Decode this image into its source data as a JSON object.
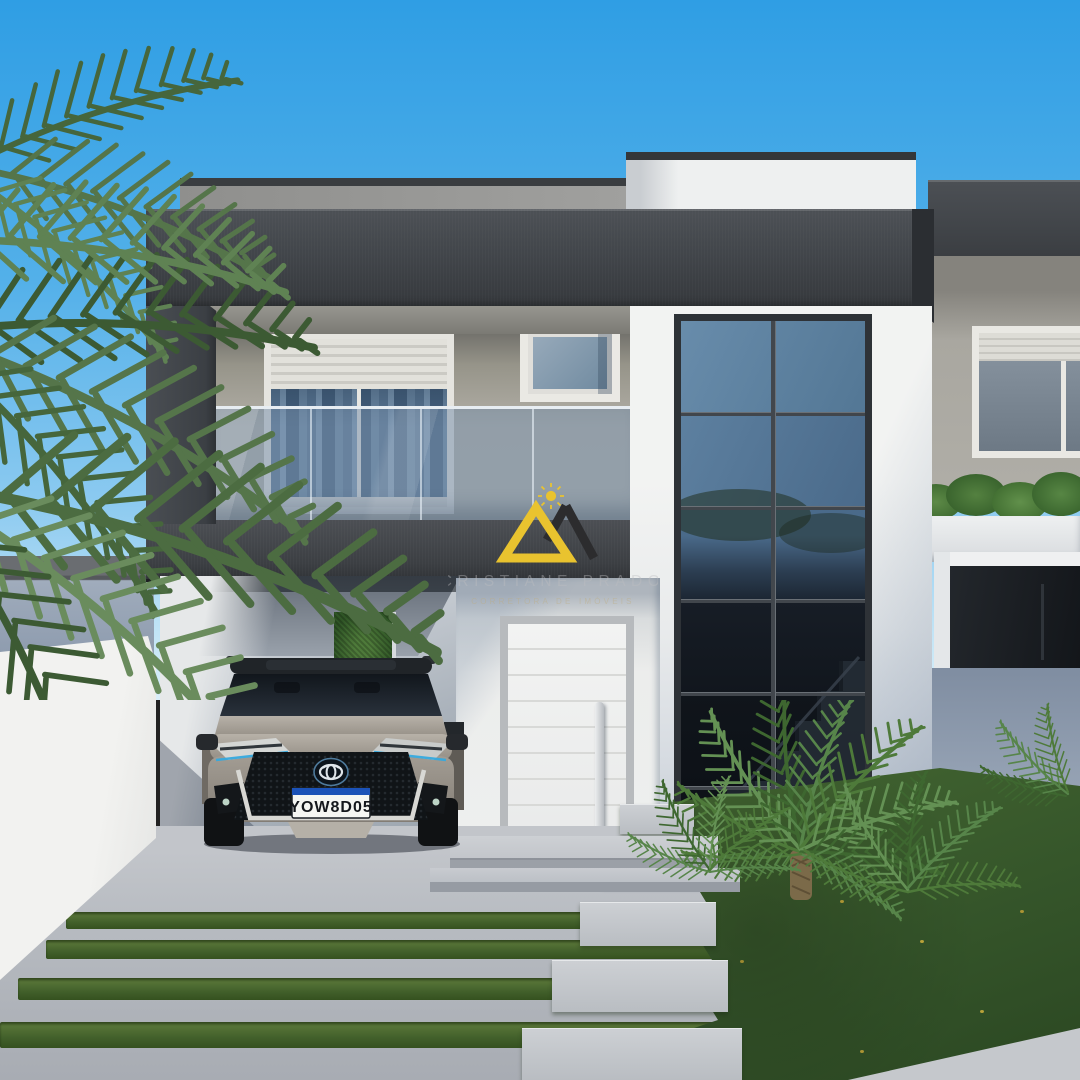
{
  "image": {
    "type": "architectural-render",
    "subject": "Modern two-story duplex house with glass balcony, carport with SUV, double-height window and landscaped yard",
    "style": "photorealistic 3D visualization"
  },
  "watermark": {
    "brand": "CRISTIANE PRADO",
    "tagline": "CORRETORA DE IMÓVEIS",
    "logo": {
      "sun_icon_color": "#e9c32f",
      "triangle_yellow": "#e9c32f",
      "triangle_dark": "#2c2c2e"
    }
  },
  "vehicle": {
    "type": "suv",
    "brand_badge": "toyota-logo",
    "body_color": "silver-gray",
    "license_plate": {
      "text": "YOW8D05",
      "style": "mercosul",
      "stripe_color": "#1b52b8"
    }
  },
  "palette": {
    "sky_top": "#2f9ee4",
    "sky_horizon": "#cfeaf8",
    "fascia_charcoal": "#3f4347",
    "wall_taupe": "#b2afa7",
    "wall_white": "#eceeee",
    "glass_reflection": "#5a7796",
    "balcony_glass": "#748ea8",
    "lawn_green": "#3a5c2d",
    "driveway_concrete": "#b7bbc1",
    "door_white": "#f4f5f4"
  },
  "scene": {
    "left": [
      "palm-tree",
      "neighbor-boundary-wall",
      "white-boundary-wall"
    ],
    "center": [
      "gray-parapet",
      "charcoal-fascia",
      "curtained-sliding-door",
      "small-window",
      "glass-balcony-railing",
      "balcony-band",
      "carport",
      "toyota-suv",
      "hedge-niche",
      "front-door",
      "entry-steps"
    ],
    "right": [
      "double-height-window",
      "interior-staircase-reflection",
      "neighbor-unit",
      "shuttered-window",
      "planter-hedge",
      "garden-sago-palms",
      "stepping-stones",
      "lawn",
      "sidewalk"
    ]
  }
}
